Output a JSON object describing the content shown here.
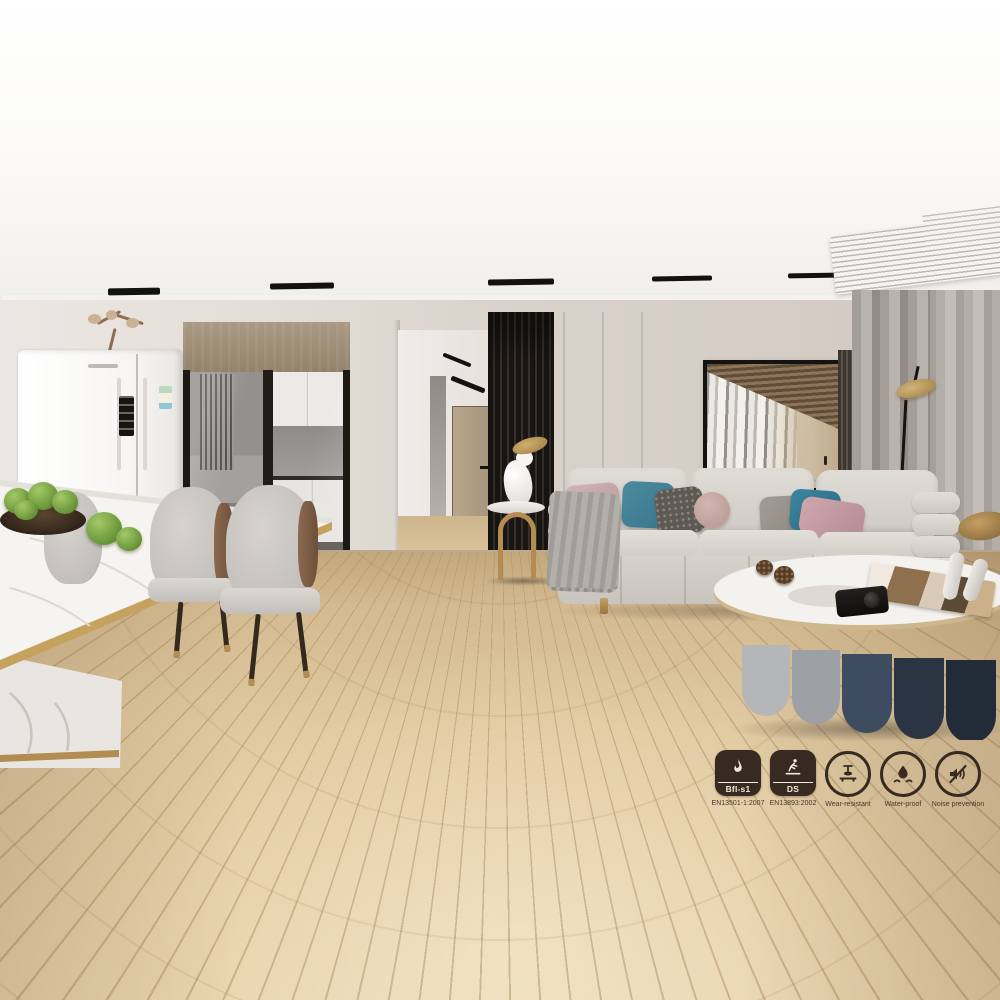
{
  "badges": {
    "items": [
      {
        "label": "Bfl-s1",
        "caption": "EN13501-1:2007",
        "icon": "flame-icon",
        "shape": "rounded-square"
      },
      {
        "label": "DS",
        "caption": "EN13893:2002",
        "icon": "slip-fall-icon",
        "shape": "rounded-square"
      },
      {
        "label": "",
        "caption": "Wear-resistant",
        "icon": "abrasion-test-icon",
        "shape": "circle"
      },
      {
        "label": "",
        "caption": "Water-proof",
        "icon": "water-drop-icon",
        "shape": "circle"
      },
      {
        "label": "",
        "caption": "Noise prevention",
        "icon": "speaker-mute-icon",
        "shape": "circle"
      }
    ]
  },
  "colors": {
    "badge": "#372b21",
    "wood-floor": "#ddc59c",
    "wall": "#d9d2cb",
    "partition": "#221e1a",
    "sofa": "#d8d3cd",
    "gold": "#b28c50",
    "teal-pillow": "#35758c",
    "pink-pillow": "#c7abad",
    "curtain": "#a59e98",
    "art-wood": "#7a6247"
  }
}
